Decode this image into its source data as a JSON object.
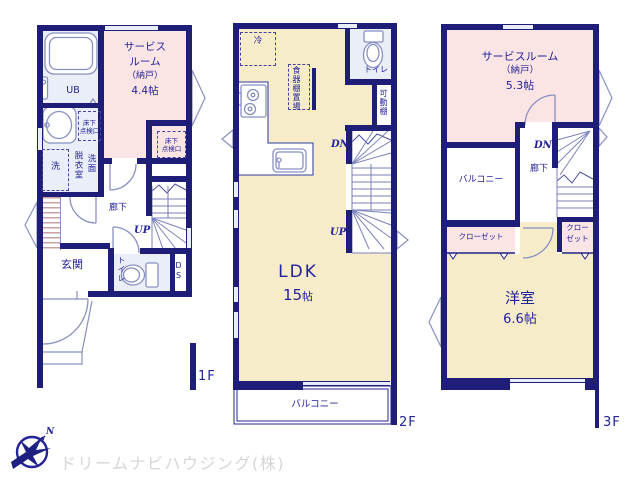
{
  "f1": {
    "ub": "UB",
    "service1": "サービス",
    "service2": "ルーム",
    "service3": "（納戸）",
    "service4": "4.4帖",
    "inspection1": "床下",
    "inspection2": "点検口",
    "wash": "洗",
    "datsui": "脱衣室",
    "senmen": "洗面",
    "hall": "廊下",
    "up": "UP",
    "genkan": "玄関",
    "toilet": "トイレ",
    "ds": "DS",
    "floor": "1F"
  },
  "f2": {
    "fridge": "冷",
    "cupboard": "食器棚置場",
    "toilet": "トイレ",
    "shelf": "可動棚",
    "dn": "DN",
    "up": "UP",
    "ldk": "LDK",
    "ldk_num": "15",
    "ldk_unit": "帖",
    "balcony": "バルコニー",
    "floor": "2F"
  },
  "f3": {
    "service1": "サービスルーム",
    "service2": "（納戸）",
    "service3": "5.3帖",
    "dn": "DN",
    "hall": "廊下",
    "balcony": "バルコニー",
    "closet_l": "クローゼット",
    "closet_r1": "クロー",
    "closet_r2": "ゼット",
    "room": "洋室",
    "size": "6.6帖",
    "floor": "3F"
  },
  "footer": {
    "company": "ドリームナビハウジング(株)",
    "north": "N"
  },
  "colors": {
    "wall": "#1e1e78",
    "text": "#23239a",
    "room_pink": "#fae4e4",
    "room_yellow": "#f7ecc9",
    "room_blue": "#e9eef9",
    "fixture_line": "#8890c2",
    "company_text": "#d6d6d6"
  }
}
